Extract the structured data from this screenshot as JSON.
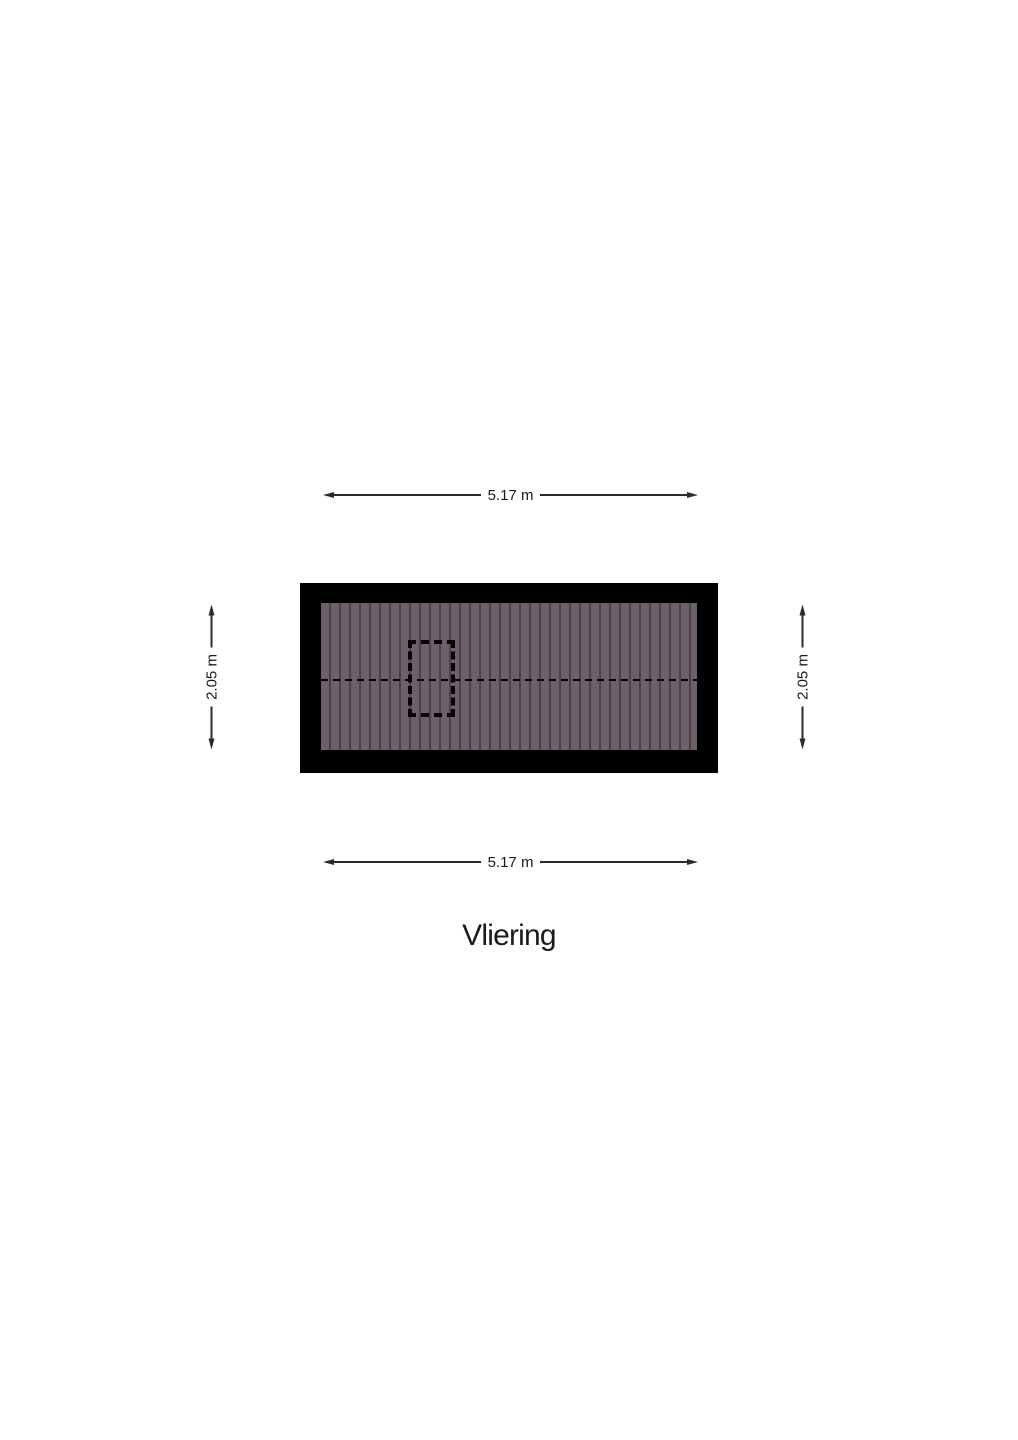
{
  "title": "Vliering",
  "dimensions": {
    "top": "5.17 m",
    "bottom": "5.17 m",
    "left": "2.05 m",
    "right": "2.05 m"
  },
  "floorplan": {
    "room_label": "Vliering",
    "features": [
      "plank-floor",
      "ridge-dashed-line",
      "hatch-opening-dashed-rectangle"
    ]
  },
  "colors": {
    "background": "#ffffff",
    "wall": "#000000",
    "floor": "#6d6069",
    "plank_line": "#4a424a",
    "dim_line": "#2b2b2b",
    "text": "#1a1a1a"
  }
}
